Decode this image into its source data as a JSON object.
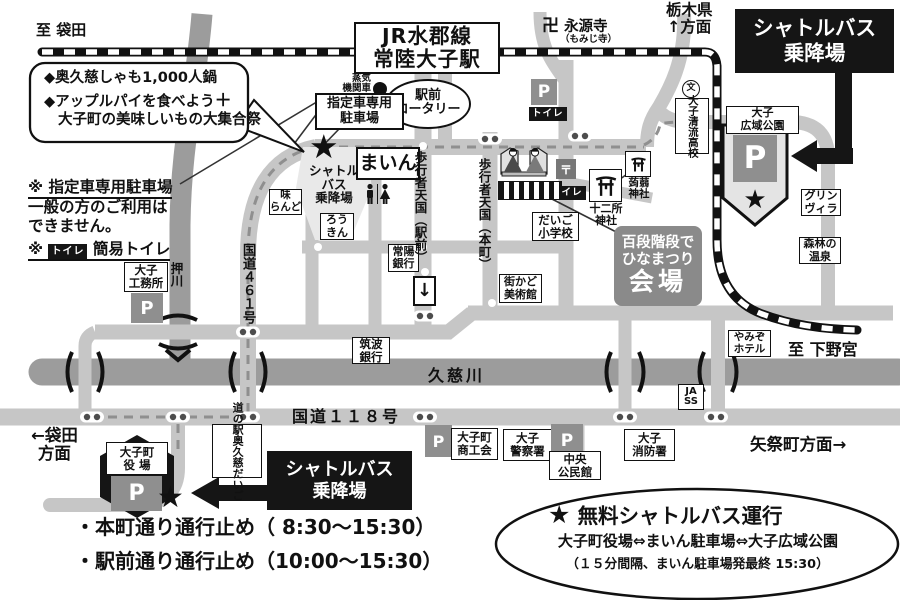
{
  "colors": {
    "road": "#c6c6c6",
    "river": "#9c9c9c",
    "ink": "#111111",
    "venue_gray": "#8a8a8a",
    "badge_gray": "#8f8f8f"
  },
  "top": {
    "to_fukuroda": "至 袋田",
    "station1": "JR水郡線",
    "station2": "常陸大子駅",
    "manji": "卍",
    "eigenji": "永源寺",
    "eigenji_sub": "（もみじ寺）",
    "tochigi1": "栃木県",
    "tochigi2": "↑方面"
  },
  "shuttle_right": {
    "l1": "シャトルバス",
    "l2": "乗降場"
  },
  "park": {
    "label1": "大子",
    "label2": "広域公園",
    "p": "P",
    "star": "★"
  },
  "right": {
    "seiryu": [
      "大子",
      "清流",
      "高校"
    ],
    "school_icon": "文",
    "greenvilla1": "グリン",
    "greenvilla2": "ヴィラ",
    "shinrin1": "森林の",
    "shinrin2": "温泉",
    "yamizo1": "やみぞ",
    "yamizo2": "ホテル",
    "to_shimonomiya": "至 下野宮",
    "jass1": "JA",
    "jass2": "SS",
    "yamatsuri": "矢祭町方面→"
  },
  "bubble": {
    "l1": "◆奥久慈しゃも1,000人鍋",
    "l2": "◆アップルパイを食べよう",
    "cross": "＋",
    "l3": "大子町の美味しいもの大集合祭"
  },
  "notes": {
    "r1a": "※ 指定車専用駐車場",
    "r1b": "一般の方のご利用は",
    "r1c": "できません。",
    "r2mark": "※",
    "r2badge": "トイレ",
    "r2text": "簡易トイレ"
  },
  "station_area": {
    "steam1": "蒸気",
    "steam2": "機関車",
    "rotary1": "駅前",
    "rotary2": "ロータリー",
    "reserved1": "指定車専用",
    "reserved2": "駐車場",
    "p": "P",
    "toilet": "トイレ",
    "post": "〒"
  },
  "center": {
    "shuttle1": "シャトル",
    "shuttle2": "バス",
    "shuttle3": "乗降場",
    "star": "★",
    "main_hall": "まいん",
    "aji1": "味",
    "aji2": "らんど",
    "roukin1": "ろう",
    "roukin2": "きん",
    "joyo1": "常陽",
    "joyo2": "銀行",
    "tsukuba1": "筑波",
    "tsukuba2": "銀行",
    "ped_ekimae": "歩行者天国（駅前）",
    "ped_honcho": "歩行者天国（本町）",
    "oneway": "↓",
    "toilet": "トイレ",
    "juniso1": "十二所",
    "juniso2": "神社",
    "konnyaku1": "蒟蒻",
    "konnyaku2": "神社",
    "elem1": "だいご",
    "elem2": "小学校",
    "machikado1": "街かど",
    "machikado2": "美術館"
  },
  "venue": {
    "l1": "百段階段で",
    "l2": "ひなまつり",
    "l3": "会場"
  },
  "west": {
    "komusho1": "大子",
    "komusho2": "工務所",
    "p": "P",
    "oshikawa": "押川",
    "r461": "国道４６１号"
  },
  "south": {
    "kuji": "久慈川",
    "r118": "国道１１８号",
    "fukuroda1": "←袋田",
    "fukuroda2": "方面",
    "yakuba1": "大子町",
    "yakuba2": "役 場",
    "yakuba_p": "P",
    "yakuba_star": "★",
    "michinoeki": [
      "道の駅",
      "奥久慈",
      "だいご"
    ],
    "shuttle1": "シャトルバス",
    "shuttle2": "乗降場",
    "shoko_p": "P",
    "shoko1": "大子町",
    "shoko2": "商工会",
    "police1": "大子",
    "police2": "警察署",
    "community_p": "P",
    "community1": "中央",
    "community2": "公民館",
    "fire1": "大子",
    "fire2": "消防署"
  },
  "bottom": {
    "closure1": "・本町通り通行止め（ 8:30～15:30）",
    "closure2": "・駅前通り通行止め（10:00～15:30）",
    "free_star": "★",
    "free_title": "無料シャトルバス運行",
    "free_route": "大子町役場⇔まいん駐車場⇔大子広域公園",
    "free_freq": "（１５分間隔、まいん駐車場発最終 15:30）"
  }
}
